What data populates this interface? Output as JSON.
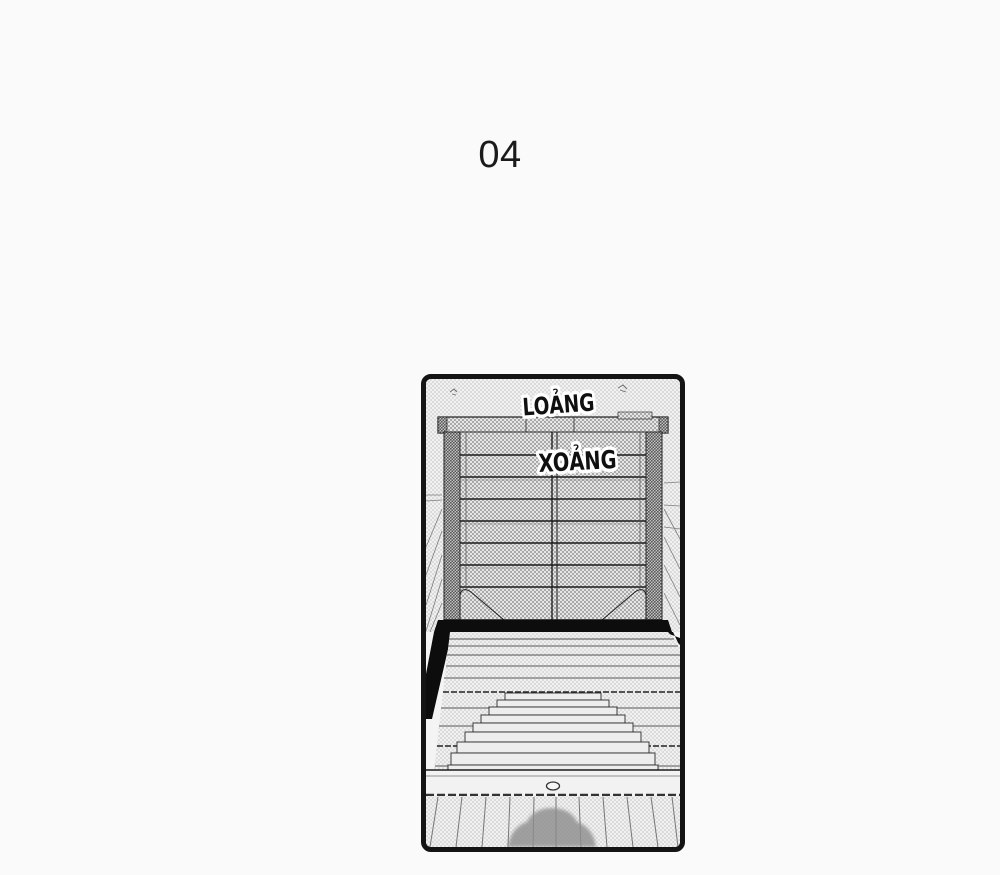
{
  "page": {
    "number_label": "04",
    "background_color": "#fafafa"
  },
  "panel": {
    "border_color": "#141414",
    "sfx": [
      {
        "text": "LOẢNG"
      },
      {
        "text": "XOẢNG"
      }
    ],
    "art_colors": {
      "tone_light": "#f1f1f1",
      "tone_medium": "#e6e6e6",
      "tone_dark": "#cfcfcf",
      "ink": "#1a1a1a",
      "gate_shadow": "#0d0d0d",
      "person_shadow": "#8d8d8d"
    }
  }
}
